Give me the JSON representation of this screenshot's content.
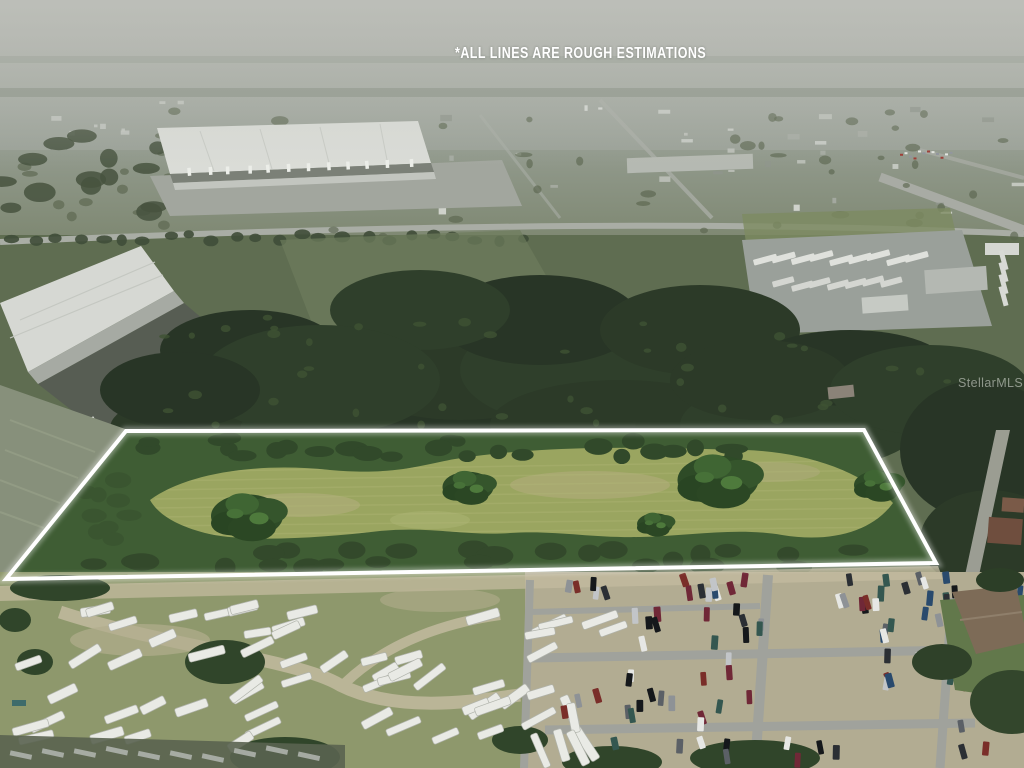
{
  "image": {
    "type": "aerial-drone-photo",
    "description": "Aerial listing photo of a vacant wooded land parcel outlined in white, bordered by an RV storage lot and vehicle lot in the foreground and an industrial warehouse district in the hazy distance",
    "disclaimer_text": "*ALL LINES ARE ROUGH ESTIMATIONS",
    "watermark_text": "StellarMLS",
    "outline_points": "126,431 864,430 936,563 6,579",
    "colors": {
      "outline": "#ffffff",
      "disclaimer_text": "#ffffff",
      "watermark_text": "#dfe3dc",
      "haze_sky": "#b3b5af",
      "distant_town": "#8b9285",
      "forest": "#2c3a28",
      "meadow": "#9aa560",
      "rv_lot_ground": "#8e986c",
      "car_lot_dirt": "#b2ac92",
      "road": "#a0a29c"
    }
  }
}
